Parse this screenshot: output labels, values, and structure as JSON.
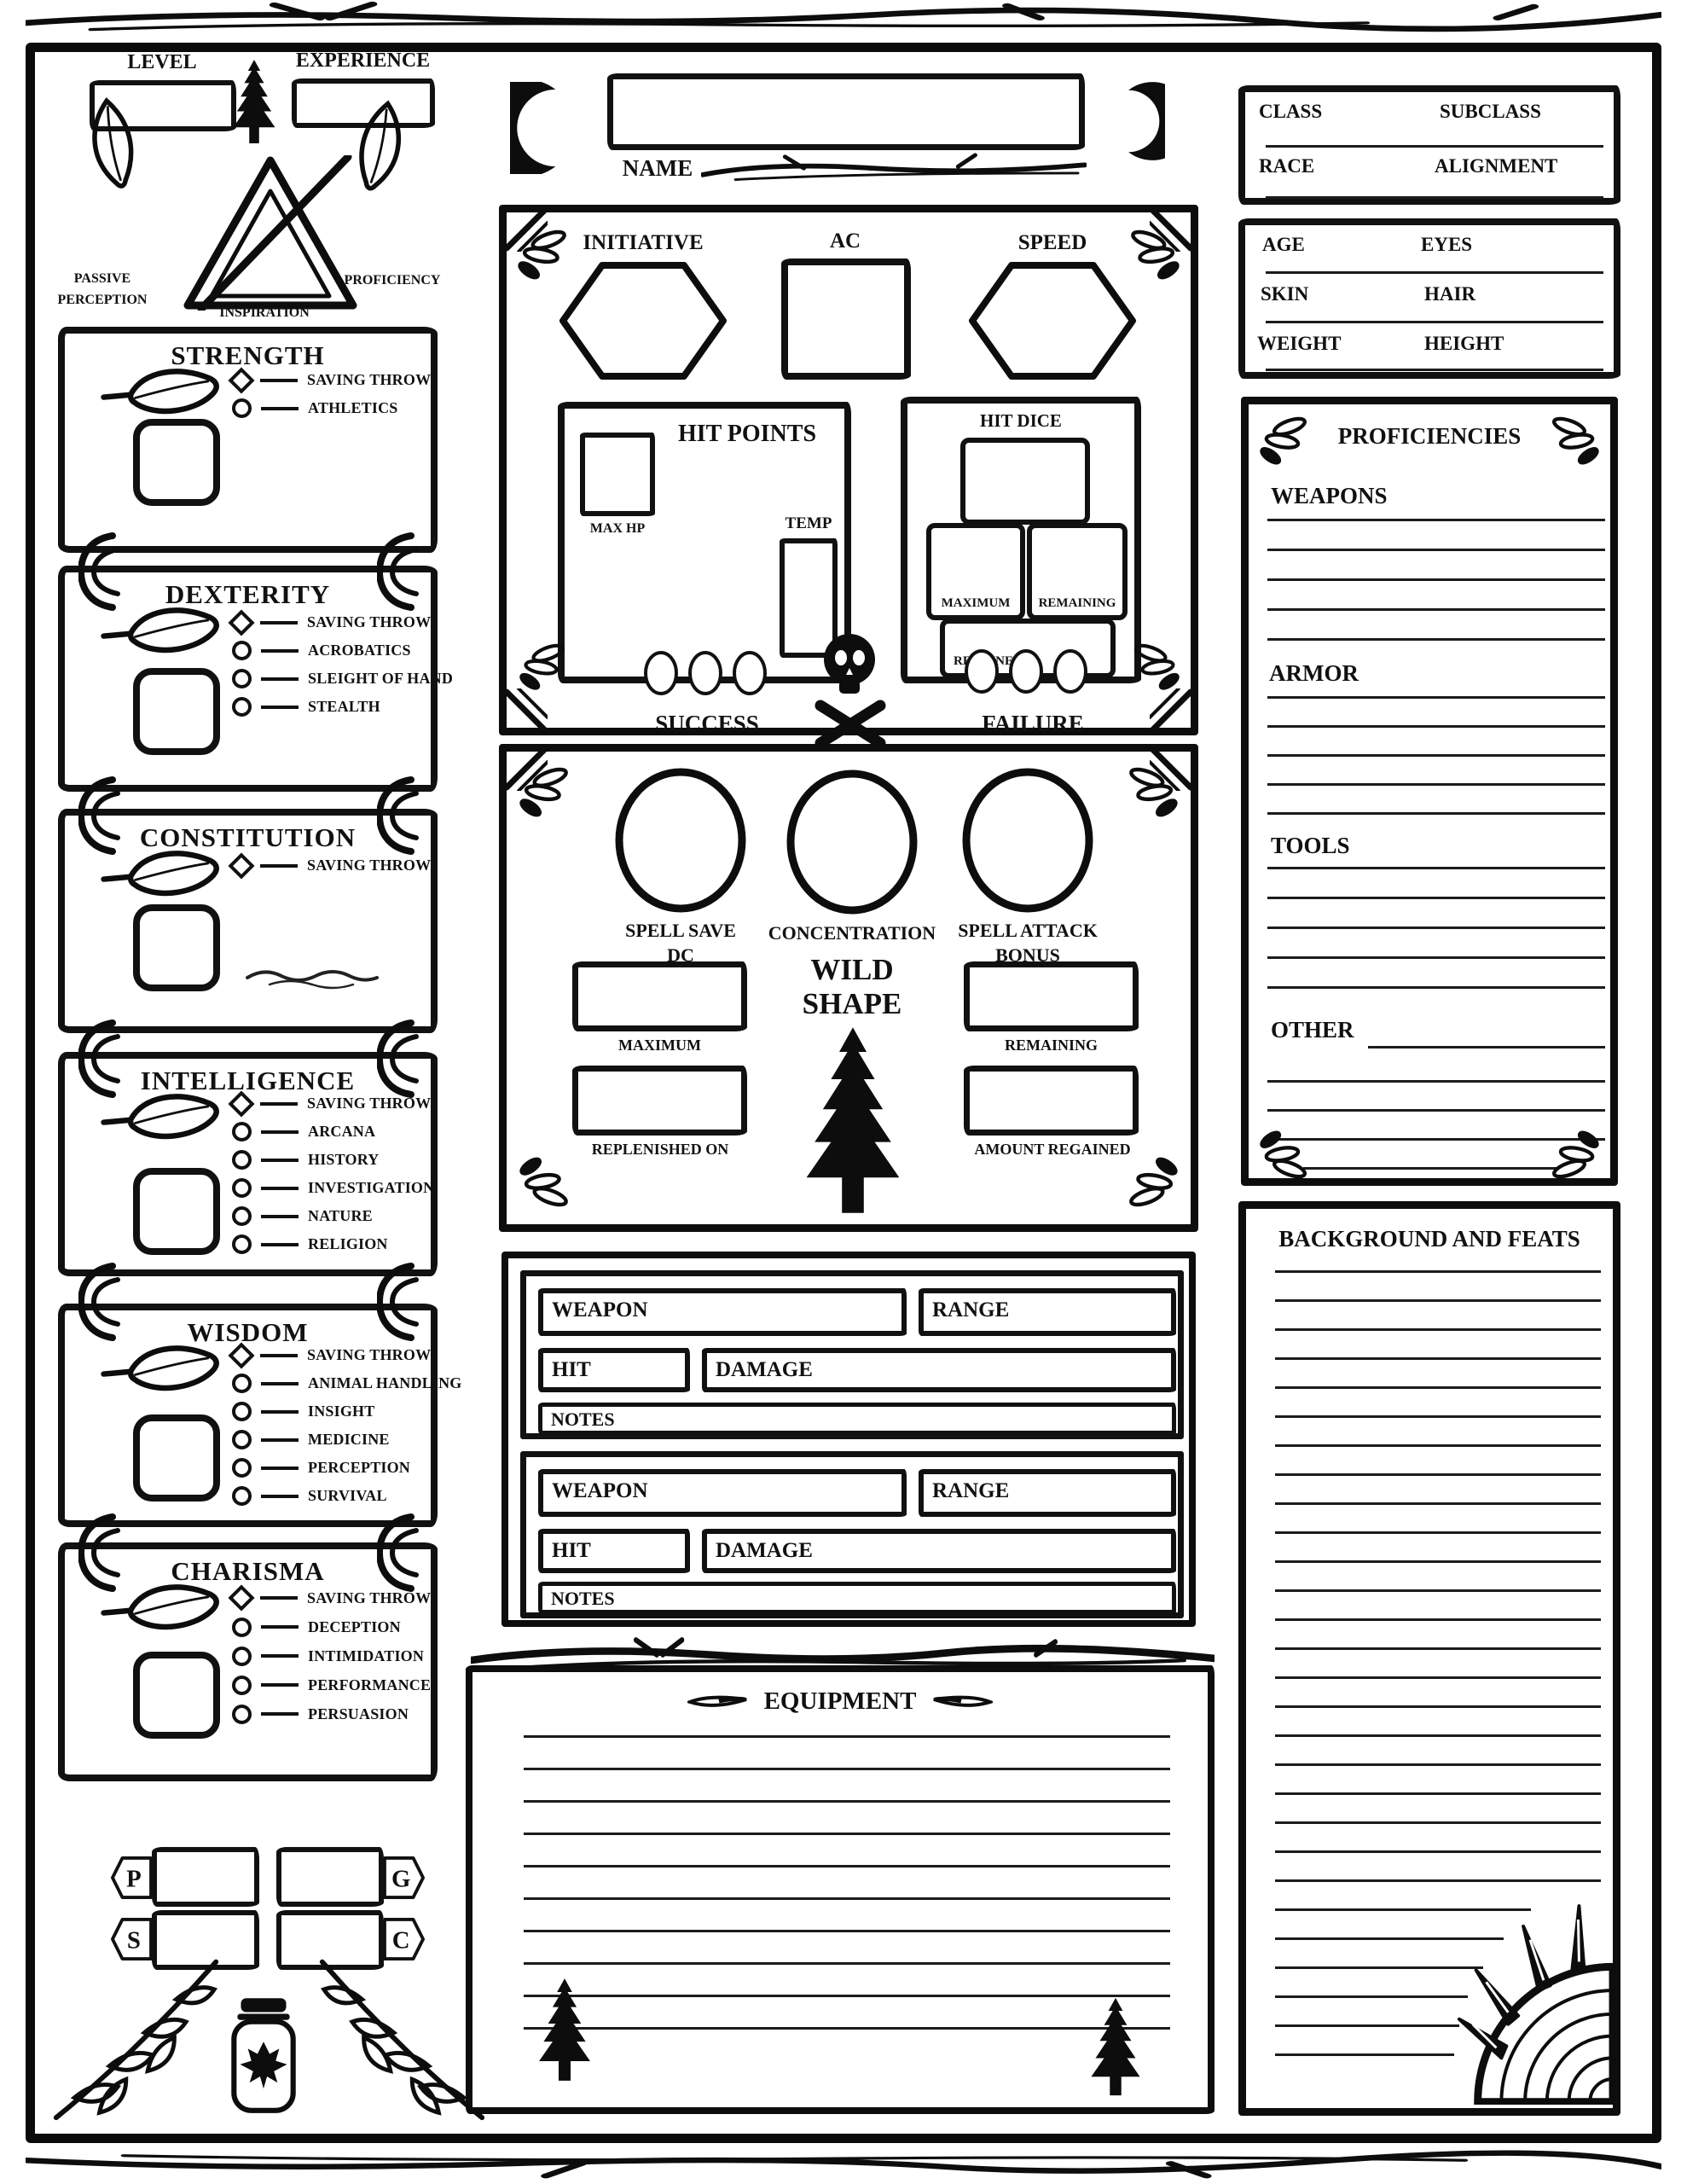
{
  "header": {
    "level_label": "LEVEL",
    "experience_label": "EXPERIENCE",
    "passive_line1": "PASSIVE",
    "passive_line2": "PERCEPTION",
    "inspiration_label": "INSPIRATION",
    "proficiency_label": "PROFICIENCY",
    "name_label": "NAME"
  },
  "abilities": [
    {
      "name": "STRENGTH",
      "skills": [
        {
          "label": "SAVING THROW"
        },
        {
          "label": "ATHLETICS"
        }
      ]
    },
    {
      "name": "DEXTERITY",
      "skills": [
        {
          "label": "SAVING THROW"
        },
        {
          "label": "ACROBATICS"
        },
        {
          "label": "SLEIGHT OF HAND"
        },
        {
          "label": "STEALTH"
        }
      ]
    },
    {
      "name": "CONSTITUTION",
      "skills": [
        {
          "label": "SAVING THROW"
        }
      ]
    },
    {
      "name": "INTELLIGENCE",
      "skills": [
        {
          "label": "SAVING THROW"
        },
        {
          "label": "ARCANA"
        },
        {
          "label": "HISTORY"
        },
        {
          "label": "INVESTIGATION"
        },
        {
          "label": "NATURE"
        },
        {
          "label": "RELIGION"
        }
      ]
    },
    {
      "name": "WISDOM",
      "skills": [
        {
          "label": "SAVING THROW"
        },
        {
          "label": "ANIMAL HANDLING"
        },
        {
          "label": "INSIGHT"
        },
        {
          "label": "MEDICINE"
        },
        {
          "label": "PERCEPTION"
        },
        {
          "label": "SURVIVAL"
        }
      ]
    },
    {
      "name": "CHARISMA",
      "skills": [
        {
          "label": "SAVING THROW"
        },
        {
          "label": "DECEPTION"
        },
        {
          "label": "INTIMIDATION"
        },
        {
          "label": "PERFORMANCE"
        },
        {
          "label": "PERSUASION"
        }
      ]
    }
  ],
  "currency": {
    "platinum": "P",
    "gold": "G",
    "silver": "S",
    "copper": "C"
  },
  "combat": {
    "initiative_label": "INITIATIVE",
    "ac_label": "AC",
    "speed_label": "SPEED",
    "hit_points_label": "HIT POINTS",
    "max_hp_label": "MAX HP",
    "temp_label": "TEMP",
    "hit_dice_label": "HIT DICE",
    "maximum_label": "MAXIMUM",
    "remaining_label": "REMAINING",
    "regained_label": "REGAINED",
    "success_label": "SUCCESS",
    "failure_label": "FAILURE"
  },
  "spellcasting": {
    "spell_save_line1": "SPELL SAVE",
    "spell_save_line2": "DC",
    "concentration_label": "CONCENTRATION",
    "spell_attack_line1": "SPELL ATTACK",
    "spell_attack_line2": "BONUS",
    "wild_line1": "WILD",
    "wild_line2": "SHAPE",
    "maximum_label": "MAXIMUM",
    "remaining_label": "REMAINING",
    "replenished_label": "REPLENISHED ON",
    "amount_regained_label": "AMOUNT REGAINED"
  },
  "weapons": {
    "cards": [
      {
        "weapon_label": "WEAPON",
        "range_label": "RANGE",
        "hit_label": "HIT",
        "damage_label": "DAMAGE",
        "notes_label": "NOTES"
      },
      {
        "weapon_label": "WEAPON",
        "range_label": "RANGE",
        "hit_label": "HIT",
        "damage_label": "DAMAGE",
        "notes_label": "NOTES"
      }
    ]
  },
  "equipment": {
    "title": "EQUIPMENT"
  },
  "details": {
    "class_label": "CLASS",
    "subclass_label": "SUBCLASS",
    "race_label": "RACE",
    "alignment_label": "ALIGNMENT",
    "age_label": "AGE",
    "eyes_label": "EYES",
    "skin_label": "SKIN",
    "hair_label": "HAIR",
    "weight_label": "WEIGHT",
    "height_label": "HEIGHT"
  },
  "proficiencies": {
    "title": "PROFICIENCIES",
    "weapons_label": "WEAPONS",
    "armor_label": "ARMOR",
    "tools_label": "TOOLS",
    "other_label": "OTHER"
  },
  "background": {
    "title": "BACKGROUND AND FEATS"
  },
  "icons": {
    "moon": "crescent-moon",
    "pine": "pine-tree",
    "skull": "skull-and-crossbones",
    "leaf": "leaf",
    "sprig": "three-leaf-sprig",
    "sun": "quarter-sun-with-rays",
    "jar": "jar-with-maple-leaf",
    "branch": "twig-branch"
  },
  "colors": {
    "ink": "#111111",
    "paper": "#ffffff"
  }
}
